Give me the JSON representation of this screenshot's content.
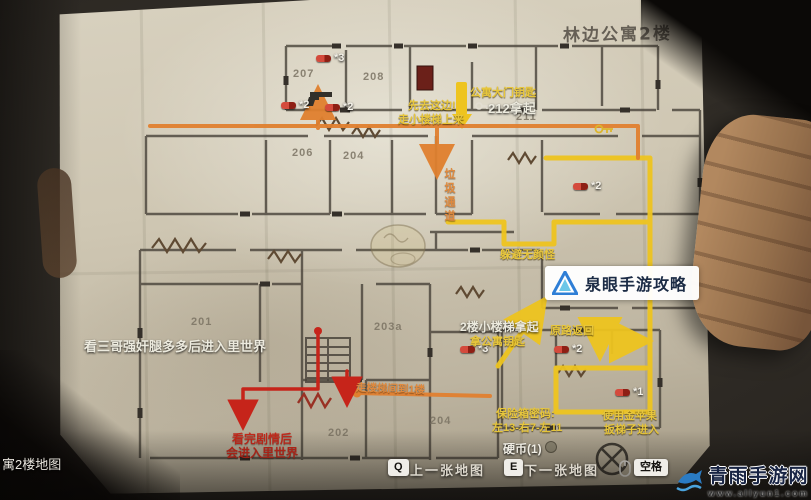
{
  "title": "林边公寓2楼",
  "hud": {
    "bottom_left_label": "寓2楼地图",
    "coin_label": "硬币(1)",
    "prev_key": "Q",
    "prev_label": "上一张地图",
    "next_key": "E",
    "next_label": "下一张地图",
    "space_key": "空格"
  },
  "map": {
    "rooms": [
      {
        "id": "207"
      },
      {
        "id": "208"
      },
      {
        "id": "206"
      },
      {
        "id": "204"
      },
      {
        "id": "211"
      },
      {
        "id": "201"
      },
      {
        "id": "203a"
      },
      {
        "id": "202"
      },
      {
        "id": "204"
      }
    ],
    "pills": [
      {
        "count": "*3"
      },
      {
        "count": "*2"
      },
      {
        "count": "*2"
      },
      {
        "count": "*2"
      },
      {
        "count": "*3"
      },
      {
        "count": "*2"
      },
      {
        "count": "*1"
      }
    ],
    "notes": {
      "otherworld": "看三哥强奸腿多多后进入里世界",
      "stairs_pickup": "2楼小楼梯拿起",
      "stairs_item": "拿公寓钥匙",
      "key_name": "公寓大门钥匙",
      "key_loc": "212拿起",
      "go_first": "先去这边!",
      "go_stairs": "走小楼梯上来",
      "chute": "垃圾通道",
      "noface": "躲避无颜怪",
      "return_back": "原路返回",
      "safe_title": "保险箱密码:",
      "safe_code": "左13-右7-左11",
      "apple1": "使用金苹果",
      "apple2": "扳梯子进入",
      "to_1f": "走楼梯间到1楼",
      "red1": "看完剧情后",
      "red2": "会进入里世界"
    }
  },
  "watermarks": {
    "center": {
      "brand": "泉眼手游攻略",
      "logo_letter": "A"
    },
    "corner": {
      "site": "青雨手游网",
      "url": "www.allyun1.com"
    }
  },
  "colors": {
    "route_orange": "#e0802f",
    "route_yellow": "#eec41f",
    "route_red": "#c6241a",
    "paper": "#cfc7b3",
    "pill_red": "#b5271e",
    "watermark_blue": "#2f7fd6"
  }
}
